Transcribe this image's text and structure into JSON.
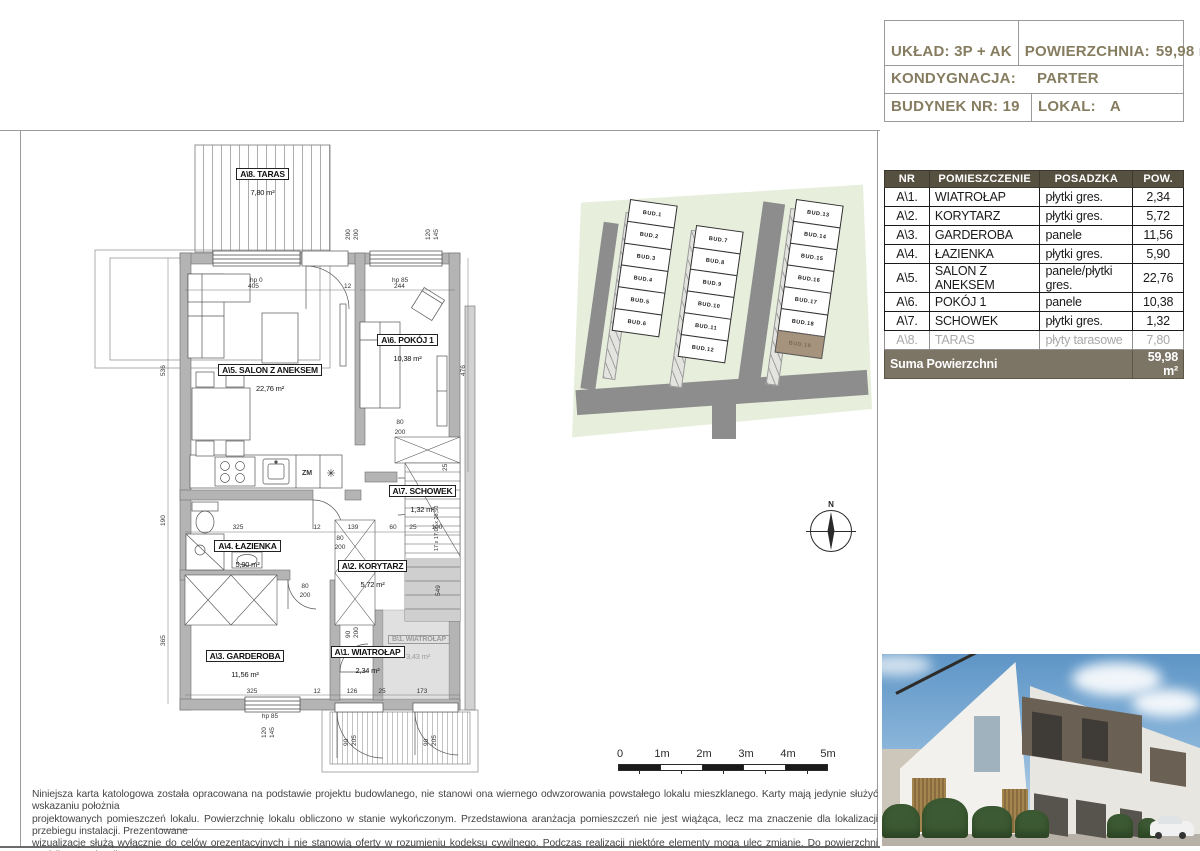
{
  "header": {
    "uklad_label": "UKŁAD:",
    "uklad": "3P + AK",
    "powierzchnia_label": "POWIERZCHNIA:",
    "powierzchnia": "59,98 m²",
    "kondygnacja_label": "KONDYGNACJA:",
    "kondygnacja": "PARTER",
    "budynek_label": "BUDYNEK NR:",
    "budynek": "19",
    "lokal_label": "LOKAL:",
    "lokal": "A"
  },
  "rooms_table": {
    "headers": [
      "NR",
      "POMIESZCZENIE",
      "POSADZKA",
      "POW."
    ],
    "rows": [
      {
        "nr": "A\\1.",
        "name": "WIATROŁAP",
        "floor": "płytki gres.",
        "area": "2,34"
      },
      {
        "nr": "A\\2.",
        "name": "KORYTARZ",
        "floor": "płytki gres.",
        "area": "5,72"
      },
      {
        "nr": "A\\3.",
        "name": "GARDEROBA",
        "floor": "panele",
        "area": "11,56"
      },
      {
        "nr": "A\\4.",
        "name": "ŁAZIENKA",
        "floor": "płytki gres.",
        "area": "5,90"
      },
      {
        "nr": "A\\5.",
        "name": "SALON Z ANEKSEM",
        "floor": "panele/płytki gres.",
        "area": "22,76"
      },
      {
        "nr": "A\\6.",
        "name": "POKÓJ 1",
        "floor": "panele",
        "area": "10,38"
      },
      {
        "nr": "A\\7.",
        "name": "SCHOWEK",
        "floor": "płytki gres.",
        "area": "1,32"
      },
      {
        "nr": "A\\8.",
        "name": "TARAS",
        "floor": "płyty tarasowe",
        "area": "7,80"
      }
    ],
    "footer_label": "Suma Powierzchni",
    "footer_value": "59,98 m²"
  },
  "site_plan": {
    "buildings": [
      "BUD.1",
      "BUD.2",
      "BUD.3",
      "BUD.4",
      "BUD.5",
      "BUD.6",
      "BUD.7",
      "BUD.8",
      "BUD.9",
      "BUD.10",
      "BUD.11",
      "BUD.12",
      "BUD.13",
      "BUD.14",
      "BUD.15",
      "BUD.16",
      "BUD.17",
      "BUD.18",
      "BUD.19"
    ],
    "highlighted": "BUD.19",
    "colors": {
      "green": "#e7efdc",
      "road": "#8d8d8d",
      "highlight": "#a6937d"
    }
  },
  "floor_plan": {
    "room_labels": {
      "taras": {
        "label": "A\\8. TARAS",
        "area": "7,80 m²"
      },
      "salon": {
        "label": "A\\5. SALON Z ANEKSEM",
        "area": "22,76 m²"
      },
      "pokoj": {
        "label": "A\\6. POKÓJ 1",
        "area": "10,38 m²"
      },
      "schowek": {
        "label": "A\\7. SCHOWEK",
        "area": "1,32 m²"
      },
      "lazienka": {
        "label": "A\\4. ŁAZIENKA",
        "area": "5,90 m²"
      },
      "korytarz": {
        "label": "A\\2. KORYTARZ",
        "area": "5,72 m²"
      },
      "garderoba": {
        "label": "A\\3. GARDEROBA",
        "area": "11,56 m²"
      },
      "wiatrolap": {
        "label": "A\\1. WIATROŁAP",
        "area": "2,34 m²"
      },
      "wiatrolap_b": {
        "label": "B\\1. WIATROŁAP",
        "area": "3,43 m²"
      }
    },
    "kitchen": {
      "zm": "ZM",
      "fridge": "✳"
    },
    "dims": {
      "hp0": "hp 0",
      "w405": "405",
      "w12": "12",
      "hp85": "hp 85",
      "w244": "244",
      "v200a": "200",
      "v200b": "200",
      "v120": "120",
      "v145": "145",
      "left536": "536",
      "left190": "190",
      "left365": "365",
      "right476": "476",
      "salon_door_w": "80",
      "salon_door_h": "200",
      "gard_door_w": "80",
      "gard_door_h": "200",
      "pokoj_door_w": "80",
      "pokoj_door_h": "200",
      "wiat_door_w": "90",
      "wiat_door_h": "200",
      "chain325": "325",
      "chain12": "12",
      "chain139": "139",
      "chain60": "60",
      "chain25": "25",
      "chain100": "100",
      "stair_formula": "17 x 17,06 x 26,50",
      "stair25": "25",
      "stair549": "549",
      "bot325": "325",
      "bot12": "12",
      "bot126": "126",
      "bot25": "25",
      "bot173": "173",
      "bot_hp85": "hp 85",
      "bot120": "120",
      "bot145": "145",
      "door90a": "90",
      "door205a": "205",
      "door90b": "90",
      "door205b": "205",
      "bath190": "190"
    }
  },
  "compass": {
    "label": "N"
  },
  "scale_bar": {
    "labels": [
      "0",
      "1m",
      "2m",
      "3m",
      "4m",
      "5m"
    ]
  },
  "disclaimer": {
    "line1": "Niniejsza karta katologowa została opracowana na podstawie projektu budowlanego, nie stanowi ona wiernego odwzorowania powstałego lokalu mieszklanego. Karty mają jedynie służyć wskazaniu położnia",
    "line2": "projektowanych pomieszczeń lokalu. Powierzchnię lokalu obliczono w stanie wykończonym. Przedstawiona aranżacja pomieszczeń nie jest wiążąca, lecz ma znaczenie dla lokalizacji przebiegu instalacji. Prezentowane",
    "line3": "wizualizacje służą wyłącznie do celów orezentacyjnych i nie stanowią oferty w rozumieniu kodeksu cywilnego. Podczas realizacji niektóre elementy mogą ulec zmianie. Do powierzchni ogródka została wliczona",
    "line4": "powierzchnia tarasu oraz ogródka przynależnego do lokalu."
  }
}
